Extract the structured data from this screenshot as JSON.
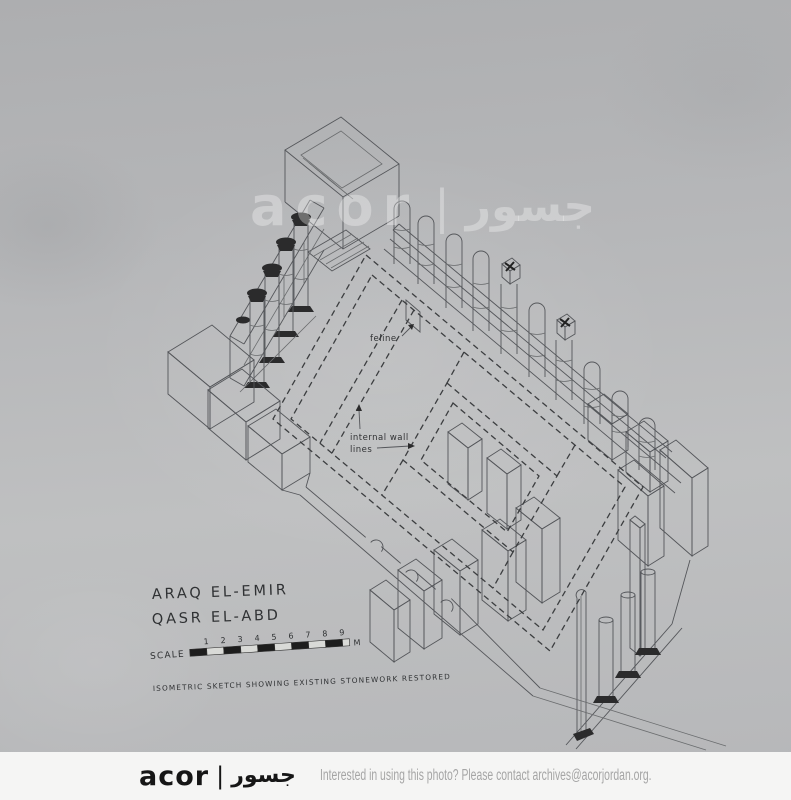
{
  "photo": {
    "watermark": {
      "latin": "acor",
      "separator": "|",
      "arabic": "جسور"
    },
    "drawing": {
      "title_line1": "ARAQ EL-EMIR",
      "title_line2": "QASR EL-ABD",
      "scale": {
        "label": "SCALE",
        "ticks": [
          "1",
          "2",
          "3",
          "4",
          "5",
          "6",
          "7",
          "8",
          "9"
        ],
        "unit": "M"
      },
      "caption": "ISOMETRIC SKETCH SHOWING EXISTING STONEWORK RESTORED",
      "labels": {
        "feline": "feline",
        "internal_wall": "internal wall",
        "lines": "lines"
      }
    }
  },
  "footer": {
    "logo": {
      "latin": "acor",
      "separator": "|",
      "arabic": "جسور"
    },
    "message": "Interested in using this photo? Please contact archives@acorjordan.org."
  }
}
